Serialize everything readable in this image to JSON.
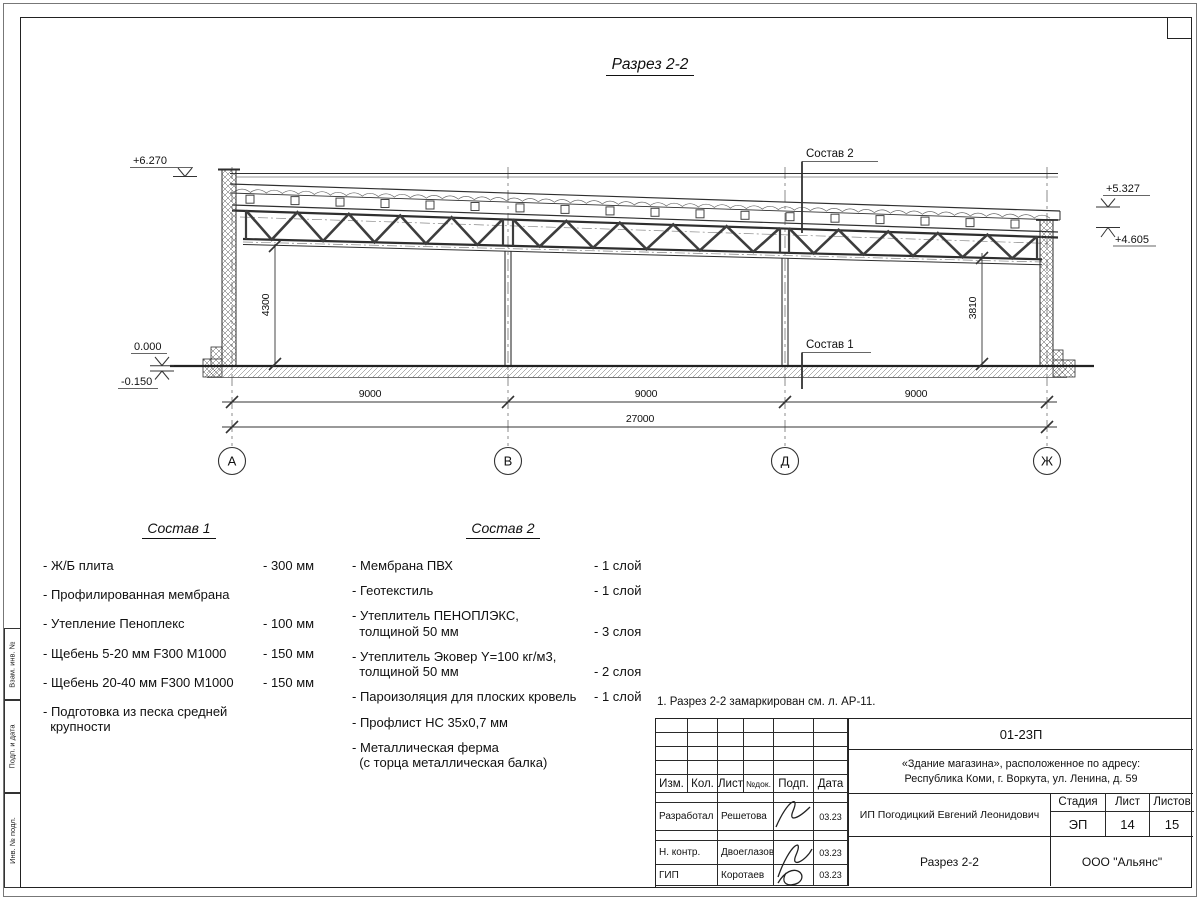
{
  "sheet": {
    "title": "Разрез 2-2",
    "note": "1. Разрез 2-2 замаркирован см. л. АР-11."
  },
  "drawing": {
    "axes": [
      "А",
      "В",
      "Д",
      "Ж"
    ],
    "span_dims": [
      "9000",
      "9000",
      "9000"
    ],
    "total_dim": "27000",
    "height_dims": {
      "left": "4300",
      "right": "3810"
    },
    "elevations": {
      "parapet_left": "+6.270",
      "roof_right_top": "+5.327",
      "roof_right_bottom": "+4.605",
      "floor": "0.000",
      "ground": "-0.150"
    },
    "leader_labels": {
      "sostav_2": "Состав 2",
      "sostav_1": "Состав 1"
    }
  },
  "sostav1": {
    "heading": "Состав 1",
    "items": [
      {
        "name": "- Ж/Б плита",
        "value": "- 300 мм"
      },
      {
        "name": "- Профилированная мембрана",
        "value": ""
      },
      {
        "name": "- Утепление Пеноплекс",
        "value": "- 100 мм"
      },
      {
        "name": "-  Щебень 5-20 мм F300 М1000",
        "value": "- 150 мм"
      },
      {
        "name": "-  Щебень 20-40 мм F300 М1000",
        "value": "- 150 мм"
      },
      {
        "name": "- Подготовка из песка средней\n  крупности",
        "value": ""
      }
    ]
  },
  "sostav2": {
    "heading": "Состав 2",
    "items": [
      {
        "name": "- Мембрана ПВХ",
        "value": "- 1 слой"
      },
      {
        "name": "- Геотекстиль",
        "value": "- 1 слой"
      },
      {
        "name": "- Утеплитель ПЕНОПЛЭКС,\n  толщиной 50 мм",
        "value": "- 3 слоя"
      },
      {
        "name": "- Утеплитель Эковер Y=100 кг/м3,\n  толщиной 50 мм",
        "value": "- 2 слоя"
      },
      {
        "name": "- Пароизоляция для плоских кровель",
        "value": "- 1 слой"
      },
      {
        "name": "- Профлист НС 35х0,7 мм",
        "value": ""
      },
      {
        "name": "- Металлическая ферма\n  (с торца металлическая балка)",
        "value": ""
      }
    ]
  },
  "titleblock": {
    "doc_number": "01-23П",
    "object_line1": "«Здание магазина», расположенное по адресу:",
    "object_line2": "Республика Коми, г. Воркута, ул. Ленина, д. 59",
    "columns": [
      "Изм.",
      "Кол.",
      "Лист",
      "№док.",
      "Подп.",
      "Дата"
    ],
    "rows": [
      {
        "role": "Разработал",
        "name": "Решетова",
        "date": "03.23"
      },
      {
        "role": "Н. контр.",
        "name": "Двоеглазов",
        "date": "03.23"
      },
      {
        "role": "ГИП",
        "name": "Коротаев",
        "date": "03.23"
      }
    ],
    "client": "ИП Погодицкий Евгений Леонидович",
    "stage_label": "Стадия",
    "sheet_label": "Лист",
    "sheets_label": "Листов",
    "stage": "ЭП",
    "sheet_no": "14",
    "sheets_total": "15",
    "drawing_name": "Разрез 2-2",
    "company": "ООО \"Альянс\""
  },
  "side_stamp": {
    "labels": [
      "Взам. инв. №",
      "Подп. и дата",
      "Инв. № подл."
    ]
  }
}
